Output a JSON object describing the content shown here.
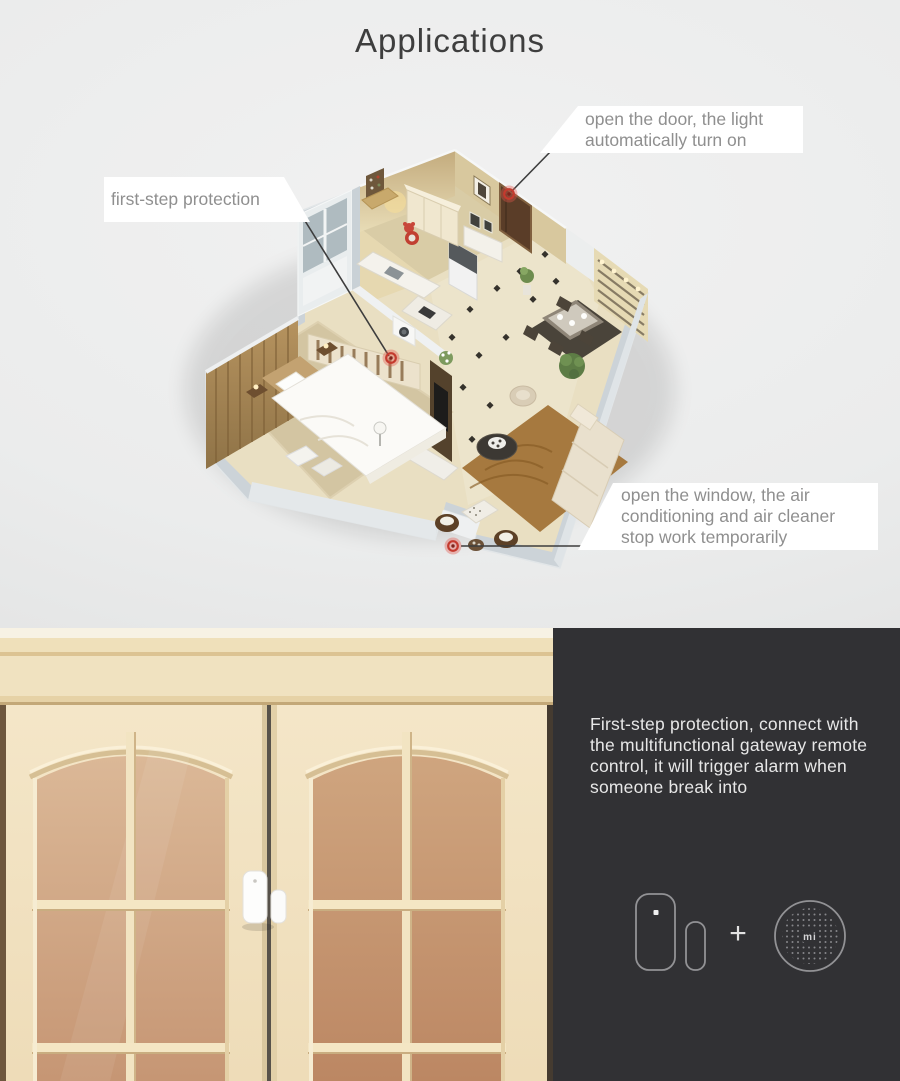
{
  "hero": {
    "title": "Applications",
    "callouts": {
      "door_light": "open the door, the light\nautomatically turn on",
      "first_step": "first-step protection",
      "window_air": "open the window, the air\nconditioning and air cleaner\nstop work temporarily"
    },
    "markers": [
      {
        "name": "front-door-sensor",
        "x": 509,
        "y": 194
      },
      {
        "name": "window-sensor",
        "x": 391,
        "y": 358
      },
      {
        "name": "living-window-sensor",
        "x": 453,
        "y": 546
      }
    ]
  },
  "panel": {
    "description": "First-step protection, connect with the multifunctional gateway remote control, it will trigger alarm when someone break into",
    "plus_label": "+",
    "gateway_logo": "mi"
  },
  "devices": {
    "door_sensor": "door-window-sensor",
    "gateway": "multifunctional-gateway"
  },
  "colors": {
    "page_bg": "#ebecec",
    "panel_bg": "#313134",
    "callout_bg": "#ffffff",
    "callout_text": "#8f8f8f",
    "title_text": "#3e3e3e",
    "panel_text": "#e7e7e7",
    "marker_red": "#c43a2e",
    "door_cream": "#f1e3c5",
    "glass_tan": "#c69674"
  }
}
